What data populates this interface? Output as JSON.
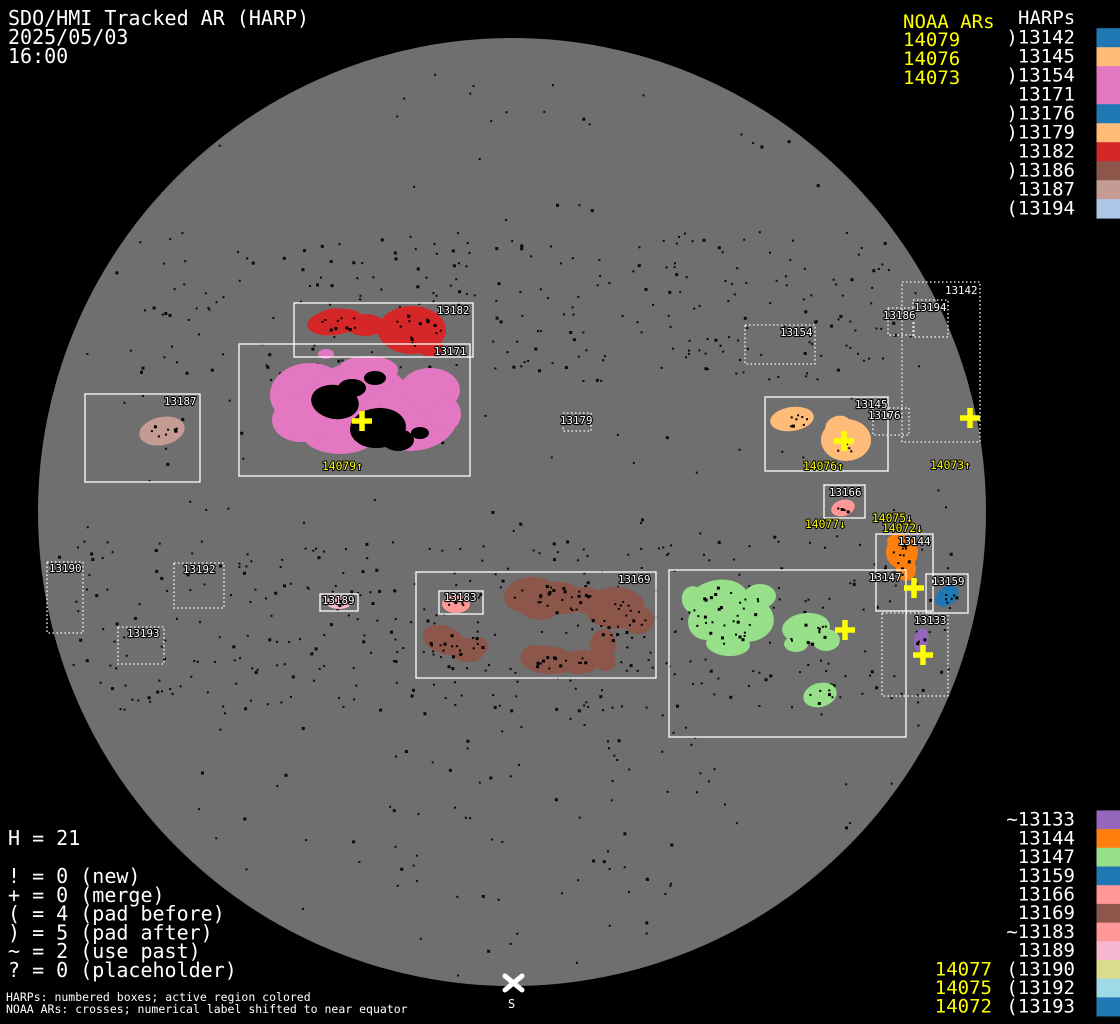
{
  "header": {
    "title": "SDO/HMI Tracked AR (HARP)",
    "date": "2025/05/03",
    "time": "16:00"
  },
  "palette": {
    "background": "#000000",
    "disk_gray": "#6f6f6f",
    "noaa_yellow": "#ffff00",
    "text_white": "#ffffff"
  },
  "harp_colors": {
    "13133": "#9467bd",
    "13142": "#1f77b4",
    "13144": "#ff7f0e",
    "13145": "#ffbb78",
    "13147": "#98df8a",
    "13154": "#e377c2",
    "13159": "#1f77b4",
    "13166": "#ff9896",
    "13169": "#8c564b",
    "13171": "#e377c2",
    "13176": "#1f77b4",
    "13179": "#ffbb78",
    "13182": "#d62728",
    "13183": "#ff9896",
    "13186": "#8c564b",
    "13187": "#c49c94",
    "13189": "#f7b6d2",
    "13190": "#dbdb8d",
    "13192": "#9edae5",
    "13193": "#1f77b4",
    "13194": "#aec7e8"
  },
  "top_right": {
    "noaa_header": "NOAA ARs",
    "noaa_items": [
      "14079",
      "14076",
      "14073"
    ],
    "harps_header": "HARPs",
    "harp_items": [
      {
        "id": "13142",
        "label": ")13142"
      },
      {
        "id": "13145",
        "label": "13145"
      },
      {
        "id": "13154",
        "label": ")13154"
      },
      {
        "id": "13171",
        "label": "13171"
      },
      {
        "id": "13176",
        "label": ")13176"
      },
      {
        "id": "13179",
        "label": ")13179"
      },
      {
        "id": "13182",
        "label": "13182"
      },
      {
        "id": "13186",
        "label": ")13186"
      },
      {
        "id": "13187",
        "label": "13187"
      },
      {
        "id": "13194",
        "label": "(13194"
      }
    ]
  },
  "bottom_right": {
    "harp_items": [
      {
        "id": "13133",
        "label": "~13133"
      },
      {
        "id": "13144",
        "label": "13144"
      },
      {
        "id": "13147",
        "label": "13147"
      },
      {
        "id": "13159",
        "label": "13159"
      },
      {
        "id": "13166",
        "label": "13166"
      },
      {
        "id": "13169",
        "label": "13169"
      },
      {
        "id": "13183",
        "label": "~13183"
      },
      {
        "id": "13189",
        "label": "13189"
      },
      {
        "id": "13190",
        "label": "(13190"
      },
      {
        "id": "13192",
        "label": "(13192"
      },
      {
        "id": "13193",
        "label": "(13193"
      }
    ],
    "noaa_items": [
      "14077",
      "14075",
      "14072"
    ]
  },
  "legend": {
    "h_count": "H = 21",
    "entries": [
      "! = 0 (new)",
      "+ = 0 (merge)",
      "( = 4 (pad before)",
      ") = 5 (pad after)",
      "~ = 2 (use past)",
      "? = 0 (placeholder)"
    ],
    "notes": [
      "HARPs: numbered boxes; active region colored",
      "NOAA ARs: crosses; numerical label shifted to near equator"
    ]
  },
  "disk": {
    "south_label": "S",
    "boxes": [
      {
        "id": "13190",
        "x": 47,
        "y": 562,
        "w": 36,
        "h": 71,
        "dash": true,
        "lx": 49,
        "ly": 572
      },
      {
        "id": "13192",
        "x": 174,
        "y": 563,
        "w": 50,
        "h": 45,
        "dash": true,
        "lx": 183,
        "ly": 573
      },
      {
        "id": "13193",
        "x": 118,
        "y": 627,
        "w": 46,
        "h": 37,
        "dash": true,
        "lx": 127,
        "ly": 637
      },
      {
        "id": "13187",
        "x": 85,
        "y": 394,
        "w": 115,
        "h": 88,
        "dash": false,
        "lx": 164,
        "ly": 405
      },
      {
        "id": "13182",
        "x": 294,
        "y": 303,
        "w": 179,
        "h": 54,
        "dash": false,
        "lx": 437,
        "ly": 314
      },
      {
        "id": "13171",
        "x": 239,
        "y": 344,
        "w": 231,
        "h": 132,
        "dash": false,
        "lx": 434,
        "ly": 355
      },
      {
        "id": "13179",
        "x": 563,
        "y": 413,
        "w": 28,
        "h": 18,
        "dash": true,
        "lx": 560,
        "ly": 424
      },
      {
        "id": "13154",
        "x": 745,
        "y": 325,
        "w": 70,
        "h": 39,
        "dash": true,
        "lx": 780,
        "ly": 336
      },
      {
        "id": "13186",
        "x": 888,
        "y": 308,
        "w": 26,
        "h": 27,
        "dash": true,
        "lx": 883,
        "ly": 319
      },
      {
        "id": "13194",
        "x": 913,
        "y": 300,
        "w": 35,
        "h": 37,
        "dash": true,
        "lx": 914,
        "ly": 311
      },
      {
        "id": "13142",
        "x": 902,
        "y": 282,
        "w": 78,
        "h": 160,
        "dash": true,
        "lx": 945,
        "ly": 294
      },
      {
        "id": "13145",
        "x": 765,
        "y": 397,
        "w": 123,
        "h": 74,
        "dash": false,
        "lx": 855,
        "ly": 408
      },
      {
        "id": "13176",
        "x": 873,
        "y": 408,
        "w": 36,
        "h": 27,
        "dash": true,
        "lx": 868,
        "ly": 419
      },
      {
        "id": "13166",
        "x": 824,
        "y": 485,
        "w": 41,
        "h": 33,
        "dash": false,
        "lx": 829,
        "ly": 496
      },
      {
        "id": "13144",
        "x": 876,
        "y": 534,
        "w": 57,
        "h": 77,
        "dash": false,
        "lx": 898,
        "ly": 545
      },
      {
        "id": "13159",
        "x": 926,
        "y": 574,
        "w": 42,
        "h": 39,
        "dash": false,
        "lx": 932,
        "ly": 585
      },
      {
        "id": "13133",
        "x": 882,
        "y": 613,
        "w": 66,
        "h": 83,
        "dash": true,
        "lx": 914,
        "ly": 624
      },
      {
        "id": "13147",
        "x": 669,
        "y": 570,
        "w": 237,
        "h": 167,
        "dash": false,
        "lx": 869,
        "ly": 581
      },
      {
        "id": "13169",
        "x": 416,
        "y": 572,
        "w": 240,
        "h": 106,
        "dash": false,
        "lx": 618,
        "ly": 583
      },
      {
        "id": "13183",
        "x": 439,
        "y": 591,
        "w": 44,
        "h": 23,
        "dash": false,
        "lx": 444,
        "ly": 601
      },
      {
        "id": "13189",
        "x": 320,
        "y": 594,
        "w": 38,
        "h": 17,
        "dash": false,
        "lx": 322,
        "ly": 604
      }
    ],
    "crosses": [
      {
        "ar": "14079",
        "x": 362,
        "y": 421
      },
      {
        "ar": "14076",
        "x": 844,
        "y": 441
      },
      {
        "ar": "14073",
        "x": 970,
        "y": 418
      },
      {
        "ar": "14077",
        "x": 845,
        "y": 630
      },
      {
        "ar": "14075",
        "x": 914,
        "y": 588
      },
      {
        "ar": "14072",
        "x": 923,
        "y": 655
      }
    ],
    "noaa_labels": [
      {
        "text": "14079↑",
        "x": 322,
        "y": 470
      },
      {
        "text": "14076↑",
        "x": 803,
        "y": 470
      },
      {
        "text": "14073↑",
        "x": 930,
        "y": 469
      },
      {
        "text": "14077↓",
        "x": 805,
        "y": 528
      },
      {
        "text": "14075↓",
        "x": 872,
        "y": 522
      },
      {
        "text": "14072↓",
        "x": 882,
        "y": 532
      }
    ]
  },
  "chart_data": {
    "type": "table",
    "title": "SDO/HMI Tracked AR (HARP) full-disk map, 2025/05/03 16:00, H = 21",
    "columns": [
      "HARP",
      "flag",
      "color",
      "disk_box_x",
      "disk_box_y",
      "disk_box_w",
      "disk_box_h"
    ],
    "rows": [
      [
        "13133",
        "~",
        "#9467bd",
        882,
        613,
        66,
        83
      ],
      [
        "13142",
        ")",
        "#1f77b4",
        902,
        282,
        78,
        160
      ],
      [
        "13144",
        "",
        "#ff7f0e",
        876,
        534,
        57,
        77
      ],
      [
        "13145",
        "",
        "#ffbb78",
        765,
        397,
        123,
        74
      ],
      [
        "13147",
        "",
        "#98df8a",
        669,
        570,
        237,
        167
      ],
      [
        "13154",
        ")",
        "#e377c2",
        745,
        325,
        70,
        39
      ],
      [
        "13159",
        "",
        "#1f77b4",
        926,
        574,
        42,
        39
      ],
      [
        "13166",
        "",
        "#ff9896",
        824,
        485,
        41,
        33
      ],
      [
        "13169",
        "",
        "#8c564b",
        416,
        572,
        240,
        106
      ],
      [
        "13171",
        "",
        "#e377c2",
        239,
        344,
        231,
        132
      ],
      [
        "13176",
        ")",
        "#1f77b4",
        873,
        408,
        36,
        27
      ],
      [
        "13179",
        ")",
        "#ffbb78",
        563,
        413,
        28,
        18
      ],
      [
        "13182",
        "",
        "#d62728",
        294,
        303,
        179,
        54
      ],
      [
        "13183",
        "~",
        "#ff9896",
        439,
        591,
        44,
        23
      ],
      [
        "13186",
        ")",
        "#8c564b",
        888,
        308,
        26,
        27
      ],
      [
        "13187",
        "",
        "#c49c94",
        85,
        394,
        115,
        88
      ],
      [
        "13189",
        "",
        "#f7b6d2",
        320,
        594,
        38,
        17
      ],
      [
        "13190",
        "(",
        "#dbdb8d",
        47,
        562,
        36,
        71
      ],
      [
        "13192",
        "(",
        "#9edae5",
        174,
        563,
        50,
        45
      ],
      [
        "13193",
        "(",
        "#1f77b4",
        118,
        627,
        46,
        37
      ],
      [
        "13194",
        "(",
        "#aec7e8",
        913,
        300,
        35,
        37
      ]
    ],
    "noaa_crosses": [
      [
        "14079",
        362,
        421
      ],
      [
        "14076",
        844,
        441
      ],
      [
        "14073",
        970,
        418
      ],
      [
        "14077",
        845,
        630
      ],
      [
        "14075",
        914,
        588
      ],
      [
        "14072",
        923,
        655
      ]
    ],
    "counts": {
      "new": 0,
      "merge": 0,
      "pad_before": 4,
      "pad_after": 5,
      "use_past": 2,
      "placeholder": 0
    }
  }
}
